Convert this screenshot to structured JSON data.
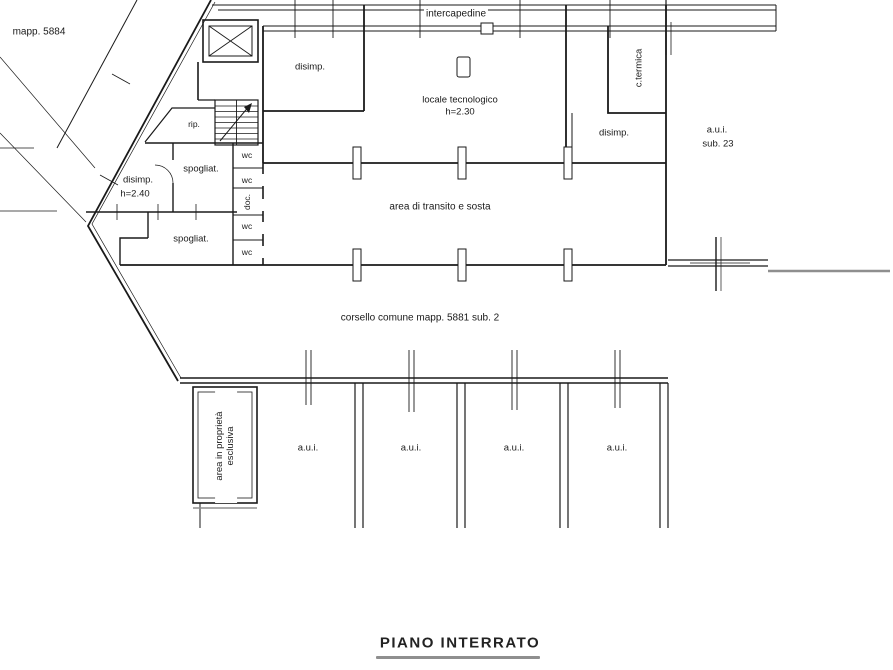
{
  "drawing": {
    "title": "PIANO INTERRATO",
    "parcel_note": "mapp. 5884",
    "labels": {
      "intercapedine": "intercapedine",
      "disimp_top": "disimp.",
      "locale_tecnologico": "locale tecnologico",
      "locale_tecnologico_height": "h=2.30",
      "c_termica": "c.termica",
      "disimp_right": "disimp.",
      "aui_unit": "a.u.i.",
      "aui_sub": "sub. 23",
      "rip": "rip.",
      "spogliatoio_1": "spogliat.",
      "spogliatoio_2": "spogliat.",
      "wc": "wc",
      "doc": "doc.",
      "disimp_left": "disimp.",
      "disimp_left_height": "h=2.40",
      "area_transito": "area di transito e sosta",
      "corsello": "corsello comune mapp. 5881 sub. 2",
      "area_proprieta_line1": "area in proprietà",
      "area_proprieta_line2": "esclusiva"
    },
    "garage_boxes": [
      {
        "label": "a.u.i."
      },
      {
        "label": "a.u.i."
      },
      {
        "label": "a.u.i."
      },
      {
        "label": "a.u.i."
      }
    ],
    "colors": {
      "line": "#1a1a1a",
      "shadow": "#8f8f8f",
      "background": "#ffffff"
    }
  }
}
